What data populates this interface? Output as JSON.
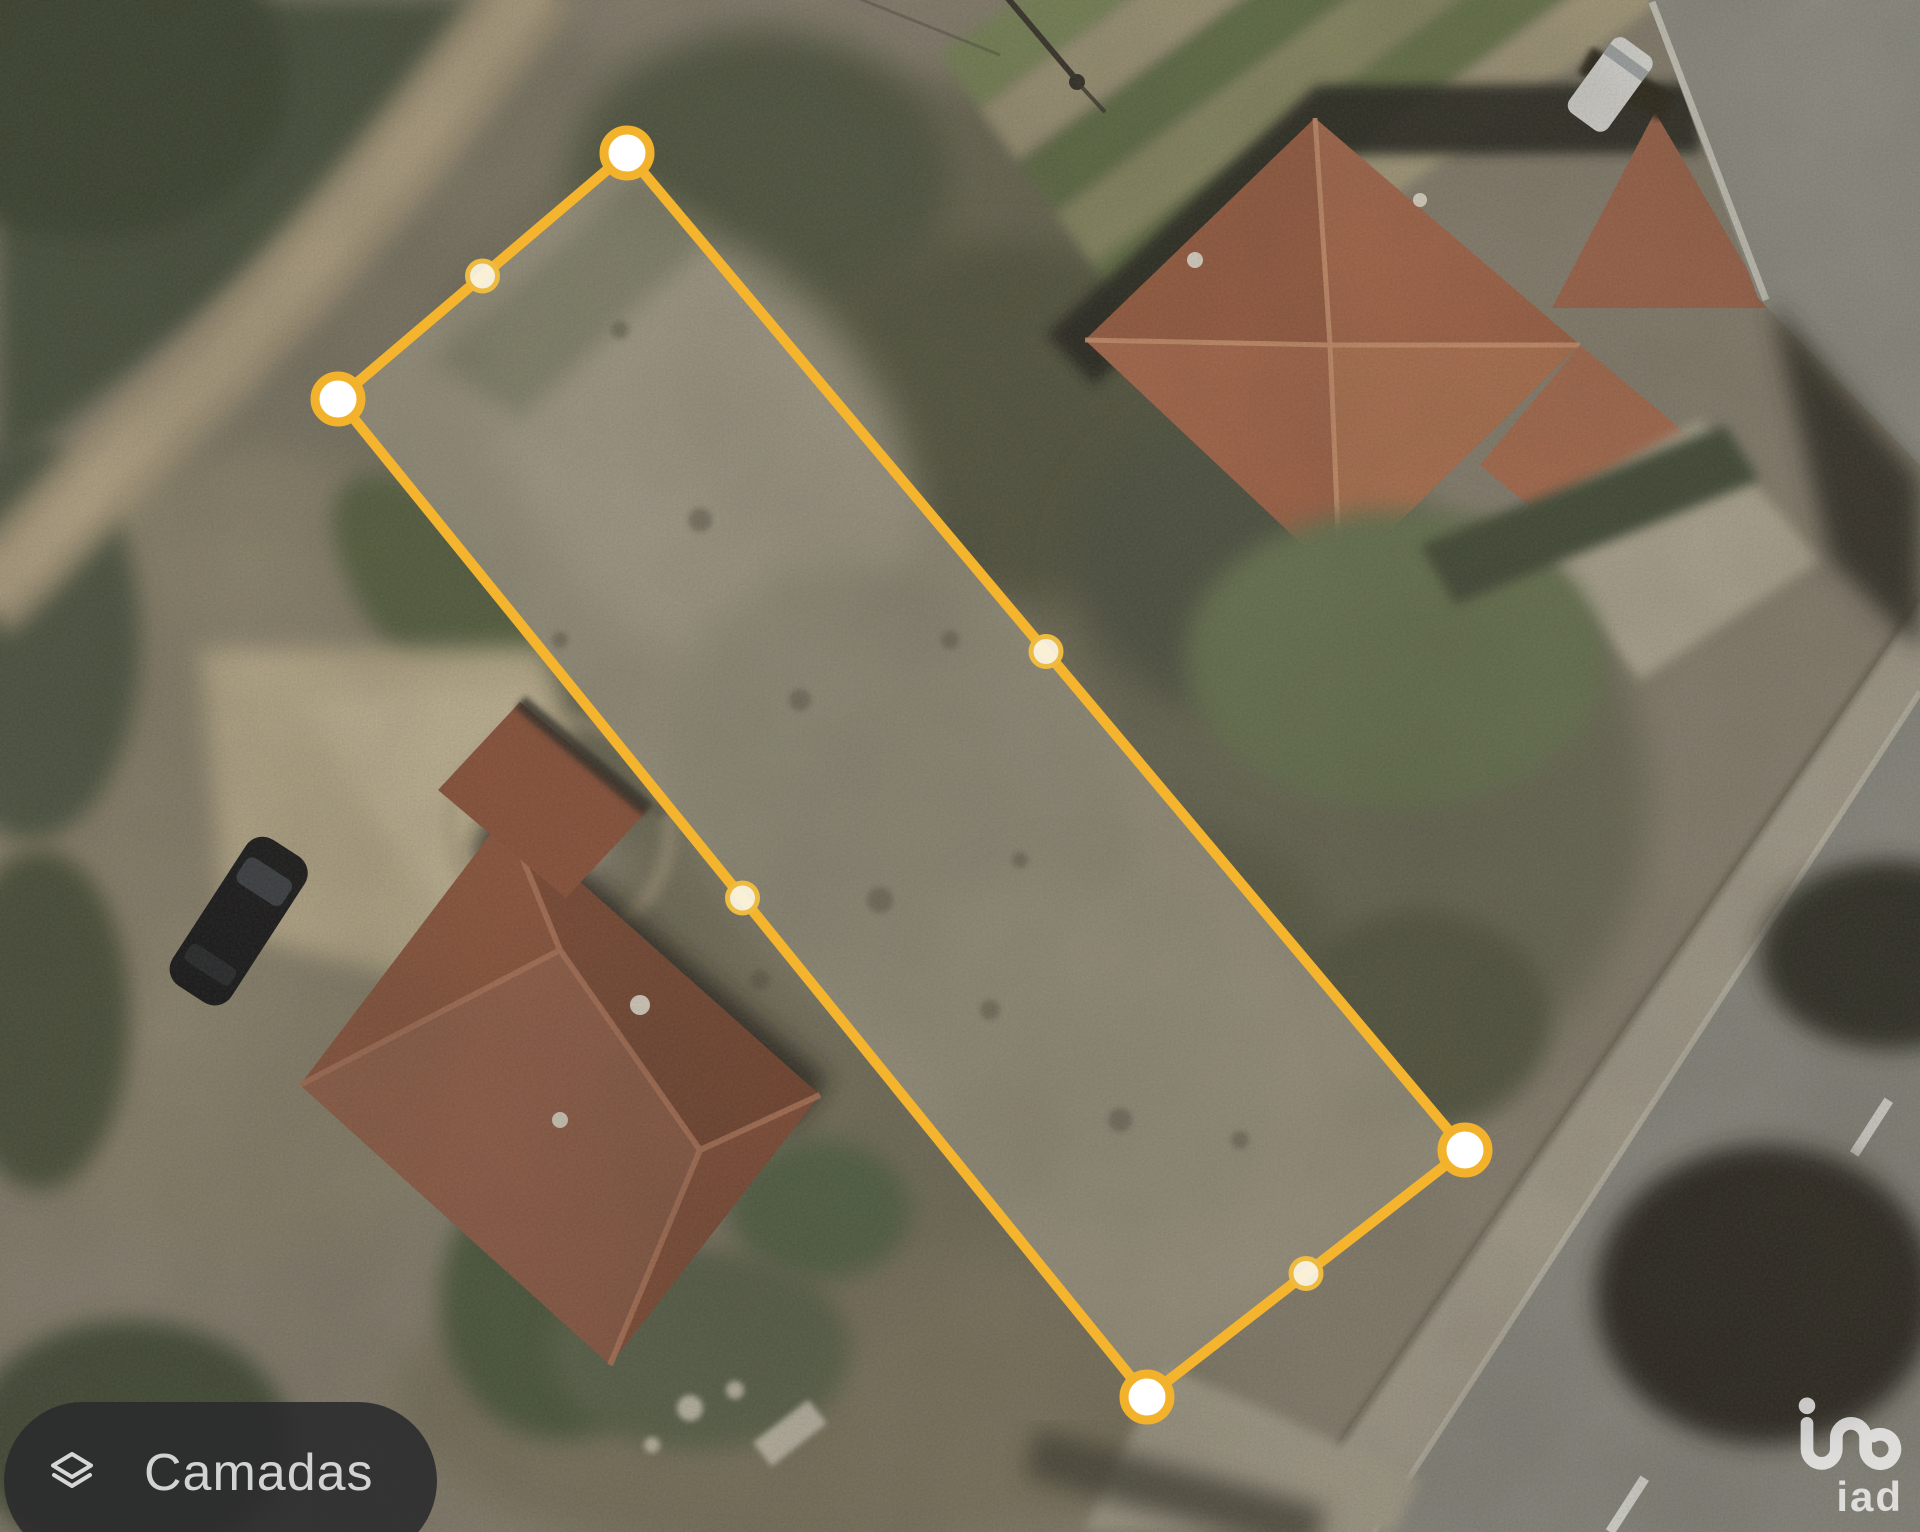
{
  "map": {
    "view": "satellite",
    "layers_button_label": "Camadas",
    "watermark_text": "iad"
  },
  "polygon": {
    "stroke_color": "#F5B42E",
    "vertex_fill": "#FFFFFF",
    "vertex_ring_color": "#F3B22B",
    "midpoint_fill": "#FAF3DF",
    "midpoint_ring_color": "#ECBB3F",
    "vertices": [
      [
        627,
        153
      ],
      [
        338,
        399
      ],
      [
        1147,
        1397
      ],
      [
        1465,
        1150
      ]
    ]
  }
}
